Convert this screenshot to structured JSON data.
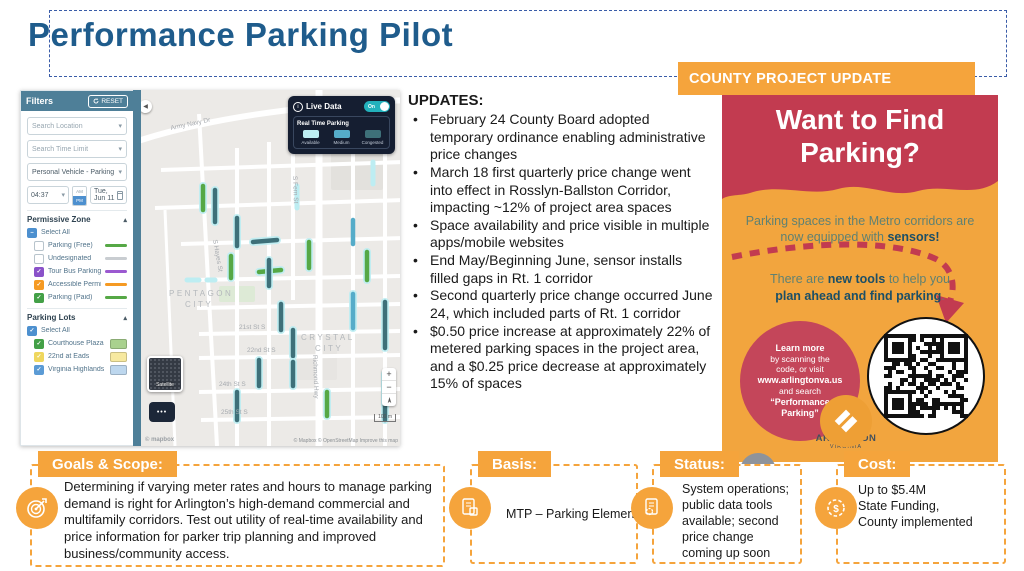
{
  "title": "Performance Parking Pilot",
  "banner": {
    "label": "COUNTY PROJECT UPDATE"
  },
  "updates": {
    "heading": "UPDATES:",
    "bullets": [
      "February 24 County Board adopted temporary ordinance enabling administrative price changes",
      "March 18 first quarterly price change went into effect in Rosslyn-Ballston Corridor, impacting ~12% of project area spaces",
      "Space availability and price visible in multiple apps/mobile websites",
      "End May/Beginning June, sensor installs filled gaps in Rt. 1 corridor",
      "Second quarterly price change occurred June 24, which included parts of Rt. 1 corridor",
      "$0.50 price increase at approximately 22% of metered parking spaces in the project area, and a $0.25 price decrease at approximately 15% of spaces"
    ]
  },
  "map_panel": {
    "filters": {
      "header": "Filters",
      "reset": "RESET",
      "search_location": "Search Location",
      "search_time_limit": "Search Time Limit",
      "vehicle_select": "Personal Vehicle - Parking",
      "time": "04:37",
      "am": "AM",
      "pm": "PM",
      "date": "Tue, Jun 11",
      "permissive_zone": {
        "title": "Permissive Zone",
        "items": [
          {
            "label": "Select All",
            "state": "indeterminate",
            "check_color": "#4D90CF"
          },
          {
            "label": "Parking (Free)",
            "state": "unchecked",
            "swatch": "line",
            "swatch_color": "#56A846"
          },
          {
            "label": "Undesignated",
            "state": "unchecked",
            "swatch": "line",
            "swatch_color": "#C9CDD1"
          },
          {
            "label": "Tour Bus Parking",
            "state": "checked",
            "check_color": "#8A52C9",
            "swatch": "line",
            "swatch_color": "#9B59D0"
          },
          {
            "label": "Accessible Permit",
            "state": "checked",
            "check_color": "#F59A23",
            "swatch": "line",
            "swatch_color": "#F59A23"
          },
          {
            "label": "Parking (Paid)",
            "state": "checked",
            "check_color": "#43A047",
            "swatch": "line",
            "swatch_color": "#56A846"
          }
        ]
      },
      "parking_lots": {
        "title": "Parking Lots",
        "items": [
          {
            "label": "Select All",
            "state": "checked",
            "check_color": "#4D90CF"
          },
          {
            "label": "Courthouse Plaza Lot",
            "state": "checked",
            "check_color": "#43A047",
            "swatch": "box",
            "swatch_color": "#A9D18E"
          },
          {
            "label": "22nd at Eads",
            "state": "checked",
            "check_color": "#EFD75E",
            "swatch": "box",
            "swatch_color": "#F7E9A0"
          },
          {
            "label": "Virginia Highlands Park",
            "state": "checked",
            "check_color": "#5B9BD5",
            "swatch": "box",
            "swatch_color": "#BDD7EE"
          }
        ]
      }
    },
    "live_data": {
      "label": "Live Data",
      "state": "On",
      "legend_title": "Real Time Parking",
      "legend": [
        {
          "label": "Available",
          "color": "#BDEDF2"
        },
        {
          "label": "Medium",
          "color": "#55ACC9"
        },
        {
          "label": "Congested",
          "color": "#3E7079"
        }
      ]
    },
    "labels": {
      "army_navy": "Army Navy Dr",
      "s_hayes": "S Hayes St",
      "s_fern": "S Fern St",
      "richmond": "Richmond Hwy",
      "pentagon_1": "PENTAGON",
      "pentagon_2": "CITY",
      "crystal_1": "CRYSTAL",
      "crystal_2": "CITY",
      "streets": [
        "21st St S",
        "22nd St S",
        "24th St S",
        "25th St S"
      ]
    },
    "controls": {
      "satellite": "Satellite",
      "more": "•••",
      "zoom_in": "+",
      "zoom_out": "−",
      "scale": "100 m",
      "attribution": "© Mapbox © OpenStreetMap Improve this map",
      "brand": "© mapbox"
    }
  },
  "poster": {
    "title": "Want to Find Parking?",
    "subtitle_pre": "Parking spaces in the Metro corridors are now equipped with ",
    "subtitle_bold": "sensors!",
    "tools_pre": "There are ",
    "tools_bold1": "new tools",
    "tools_mid": " to help you ",
    "tools_bold2": "plan ahead and find parking",
    "tools_end": ".",
    "learn": [
      "Learn more",
      "by scanning the",
      "code, or visit",
      "www.arlingtonva.us",
      "and search",
      "“Performance",
      "Parking”"
    ],
    "logo_line1": "ARLINGTON",
    "logo_line2": "VIRGINIA"
  },
  "sections": {
    "goals": {
      "label": "Goals & Scope:",
      "text": "Determining if varying meter rates and hours to manage parking demand is right for Arlington’s high-demand commercial and multifamily corridors. Test out utility of real-time availability and price information for parker trip planning and improved business/community access."
    },
    "basis": {
      "label": "Basis:",
      "text": "MTP – Parking Element"
    },
    "status": {
      "label": "Status:",
      "text": "System operations; public data tools available; second price change coming up soon"
    },
    "cost": {
      "label": "Cost:",
      "text": "Up to $5.4M\nState Funding,\nCounty implemented"
    }
  }
}
